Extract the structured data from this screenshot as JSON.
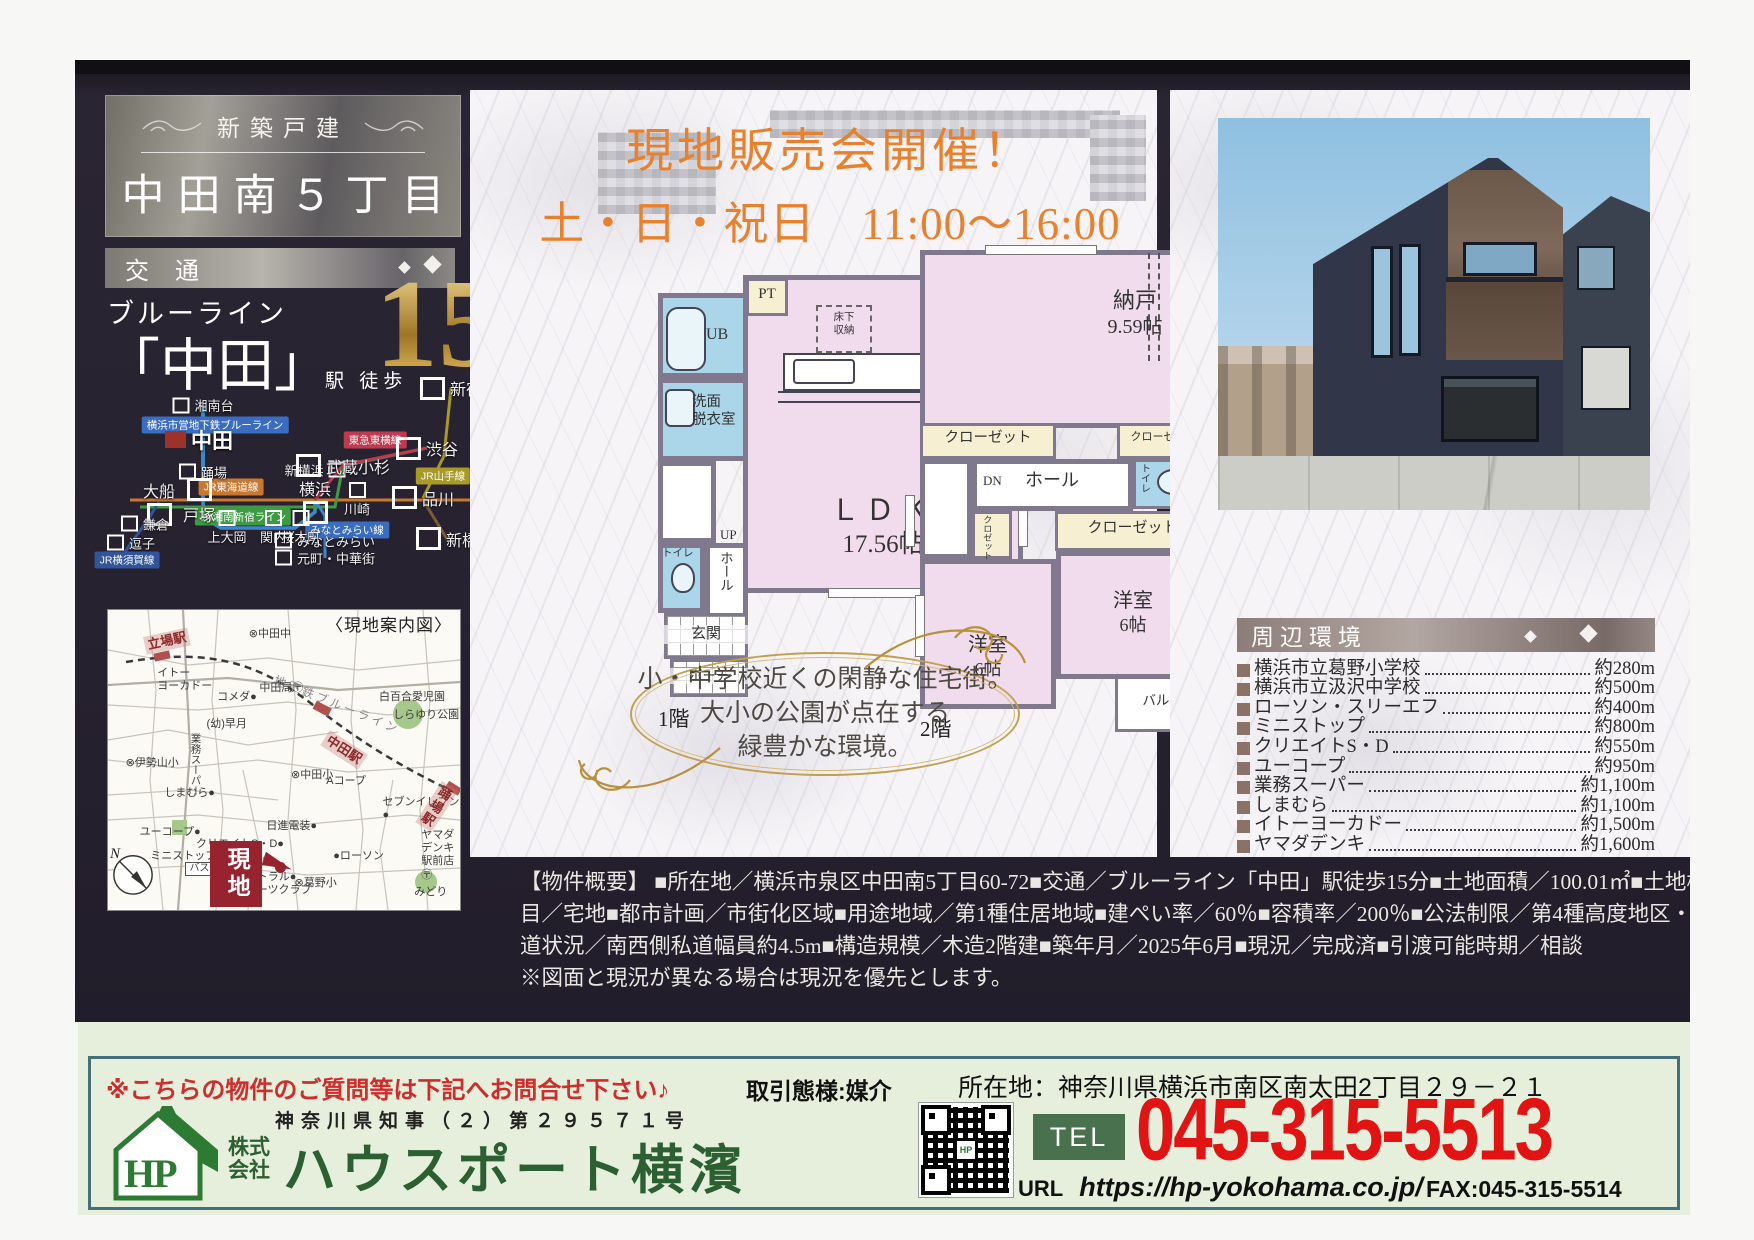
{
  "header": {
    "badge": "新築戸建",
    "title": "中田南５丁目",
    "transport_label": "交通"
  },
  "access": {
    "line": "ブルーライン",
    "station": "「中田」",
    "walk": "駅 徒歩",
    "minutes": "15",
    "unit": "分"
  },
  "rail_map": {
    "line_labels": [
      {
        "text": "横浜市営地下鉄ブルーライン",
        "bg": "#3a6cc0",
        "x": 30,
        "y": 31
      },
      {
        "text": "東急東横線",
        "bg": "#bf3a4e",
        "x": 70,
        "y": 38
      },
      {
        "text": "JR東海道線",
        "bg": "#c87830",
        "x": 34,
        "y": 60
      },
      {
        "text": "JR湘南新宿ライン",
        "bg": "#3f9a44",
        "x": 37,
        "y": 74
      },
      {
        "text": "JR山手線",
        "bg": "#a89a28",
        "x": 87,
        "y": 55
      },
      {
        "text": "みなとみらい線",
        "bg": "#3a6cc0",
        "x": 63,
        "y": 80
      },
      {
        "text": "JR横須賀線",
        "bg": "#32549a",
        "x": 8,
        "y": 94
      }
    ],
    "stations": [
      {
        "name": "湘南台",
        "x": 27,
        "y": 22,
        "cls": "sm lb-r"
      },
      {
        "name": "中田",
        "x": 26,
        "y": 38,
        "cls": "nakada lb-r"
      },
      {
        "name": "踊場",
        "x": 27,
        "y": 53,
        "cls": "sm lb-r"
      },
      {
        "name": "新横浜",
        "x": 55,
        "y": 52,
        "cls": "sm lb-l"
      },
      {
        "name": "武蔵小杉",
        "x": 62,
        "y": 50,
        "cls": "bg lb-r"
      },
      {
        "name": "渋谷",
        "x": 83,
        "y": 42,
        "cls": "bg lb-r"
      },
      {
        "name": "新宿",
        "x": 89,
        "y": 14,
        "cls": "bg lb-r"
      },
      {
        "name": "大船",
        "x": 16,
        "y": 67,
        "cls": "bg lb-a"
      },
      {
        "name": "戸塚",
        "x": 26,
        "y": 67,
        "cls": "bg lb-b"
      },
      {
        "name": "横浜",
        "x": 55,
        "y": 66,
        "cls": "bg lb-a"
      },
      {
        "name": "川崎",
        "x": 65.5,
        "y": 66,
        "cls": "sm lb-b"
      },
      {
        "name": "品川",
        "x": 82,
        "y": 65,
        "cls": "bg lb-r"
      },
      {
        "name": "新橋",
        "x": 88,
        "y": 84,
        "cls": "bg lb-r"
      },
      {
        "name": "鎌倉",
        "x": 12.5,
        "y": 77,
        "cls": "sm lb-r"
      },
      {
        "name": "逗子",
        "x": 9,
        "y": 86,
        "cls": "sm lb-r"
      },
      {
        "name": "上大岡",
        "x": 33,
        "y": 79,
        "cls": "sm lb-b"
      },
      {
        "name": "関内",
        "x": 44.5,
        "y": 79,
        "cls": "sm lb-b"
      },
      {
        "name": "桜木町",
        "x": 51.5,
        "y": 79,
        "cls": "sm lb-b"
      },
      {
        "name": "みなとみらい",
        "x": 57.5,
        "y": 85,
        "cls": "sm lb-r"
      },
      {
        "name": "元町・中華街",
        "x": 57.5,
        "y": 93,
        "cls": "sm lb-r"
      }
    ]
  },
  "area_map": {
    "caption": "〈現地案内図〉",
    "site_label": "現地",
    "labels": [
      {
        "text": "立場駅",
        "x": 10,
        "y": 9,
        "cls": "redlab",
        "rot": -12
      },
      {
        "text": "イトー\nヨーカドー",
        "x": 14,
        "y": 19
      },
      {
        "text": "コメダ●",
        "x": 31,
        "y": 27
      },
      {
        "text": "⊗中田中",
        "x": 40,
        "y": 6
      },
      {
        "text": "中田局〶",
        "x": 43,
        "y": 24
      },
      {
        "text": "地下鉄ブルーライン",
        "x": 48,
        "y": 21,
        "cls": "rail-name",
        "rot": 22
      },
      {
        "text": "中田駅",
        "x": 63,
        "y": 40,
        "cls": "redlab",
        "rot": 33
      },
      {
        "text": "白百合愛児園",
        "x": 77,
        "y": 27
      },
      {
        "text": "しらゆり公園",
        "x": 81,
        "y": 33
      },
      {
        "text": "(幼)早月",
        "x": 28,
        "y": 36
      },
      {
        "text": "⊗伊勢山小",
        "x": 5,
        "y": 49
      },
      {
        "text": "業務スーパー",
        "x": 23,
        "y": 41,
        "cls": "vert"
      },
      {
        "text": "しまむら●",
        "x": 16,
        "y": 59
      },
      {
        "text": "ユーコープ●",
        "x": 9,
        "y": 72
      },
      {
        "text": "クリエイトS・D●",
        "x": 25,
        "y": 76
      },
      {
        "text": "ミニストップ●",
        "x": 12,
        "y": 80
      },
      {
        "text": "ローソン●",
        "x": 34,
        "y": 82
      },
      {
        "text": "セントラル●\nスポーツクラブ",
        "x": 36,
        "y": 87
      },
      {
        "text": "⊗中田小",
        "x": 52,
        "y": 53
      },
      {
        "text": "Aコープ",
        "x": 62,
        "y": 55
      },
      {
        "text": "日進電装●",
        "x": 45,
        "y": 70
      },
      {
        "text": "●ローソン",
        "x": 64,
        "y": 80
      },
      {
        "text": "セブンイレブン●",
        "x": 78,
        "y": 62
      },
      {
        "text": "ヤマダデンキ\n駅前店〶",
        "x": 89,
        "y": 73
      },
      {
        "text": "⊗葛野小",
        "x": 53,
        "y": 89
      },
      {
        "text": "みどり",
        "x": 87,
        "y": 92
      },
      {
        "text": "踊場駅",
        "x": 95,
        "y": 57,
        "cls": "redlab",
        "rot": 33
      },
      {
        "text": "バス停",
        "x": 22,
        "y": 84,
        "cls": "boxed"
      }
    ]
  },
  "event": {
    "line1": "現地販売会開催！",
    "line2": "土・日・祝日　11:00〜16:00"
  },
  "floorplan1": {
    "floor_label": "1階",
    "pt": "PT",
    "underfloor": "床下\n収納",
    "ub": "UB",
    "washroom": "洗面\n脱衣室",
    "ldk": "ＬＤＫ",
    "ldk_size": "17.56帖",
    "up": "UP",
    "toilet": "トイレ",
    "hall": "ホール",
    "entrance": "玄関",
    "porch": "ポーチ"
  },
  "floorplan2": {
    "floor_label": "2階",
    "storage": "納戸",
    "storage_size": "9.59帖",
    "closet_left": "クローゼット",
    "closet_right": "クローゼット",
    "closet_mid": "クローゼット",
    "closet_small": "クロゼット",
    "toilet": "トイレ",
    "dn": "DN",
    "hall": "ホール",
    "room_left": "洋室",
    "room_left_size": "6帖",
    "room_right": "洋室",
    "room_right_size": "6帖",
    "balcony": "バルコニー"
  },
  "catch": {
    "line1": "小・中学校近くの閑静な住宅街。",
    "line2": "大小の公園が点在する",
    "line3": "緑豊かな環境。"
  },
  "environment": {
    "header": "周辺環境",
    "items": [
      {
        "name": "横浜市立葛野小学校",
        "distance": "約280m"
      },
      {
        "name": "横浜市立汲沢中学校",
        "distance": "約500m"
      },
      {
        "name": "ローソン・スリーエフ",
        "distance": "約400m"
      },
      {
        "name": "ミニストップ",
        "distance": "約800m"
      },
      {
        "name": "クリエイトS・D",
        "distance": "約550m"
      },
      {
        "name": "ユーコープ",
        "distance": "約950m"
      },
      {
        "name": "業務スーパー",
        "distance": "約1,100m"
      },
      {
        "name": "しまむら",
        "distance": "約1,100m"
      },
      {
        "name": "イトーヨーカドー",
        "distance": "約1,500m"
      },
      {
        "name": "ヤマダデンキ",
        "distance": "約1,600m"
      }
    ]
  },
  "overview": {
    "lines": [
      "【物件概要】 ■所在地／横浜市泉区中田南5丁目60-72■交通／ブルーライン「中田」駅徒歩15分■土地面積／100.01㎡■土地権利／所有権■地",
      "目／宅地■都市計画／市街化区域■用途地域／第1種住居地域■建ぺい率／60％■容積率／200％■公法制限／第4種高度地区・準防火地域■接",
      "道状況／南西側私道幅員約4.5m■構造規模／木造2階建■築年月／2025年6月■現況／完成済■引渡可能時期／相談",
      "※図面と現況が異なる場合は現況を優先とします。"
    ]
  },
  "misc": {
    "compass_n": "N"
  },
  "footer": {
    "message": "※こちらの物件のご質問等は下記へお問合せ下さい♪",
    "license": "神奈川県知事（２）第２９５７１号",
    "logo_text": "HP",
    "company_prefix1": "株式",
    "company_prefix2": "会社",
    "company_name": "ハウスポート横濱",
    "dealing": "取引態様:媒介",
    "office_address": "所在地：神奈川県横浜市南区南太田2丁目２９－２１",
    "tel_label": "TEL",
    "tel_number": "045-315-5513",
    "url_label": "URL",
    "url_value": "https://hp-yokohama.co.jp/",
    "fax": "FAX:045-315-5514"
  }
}
